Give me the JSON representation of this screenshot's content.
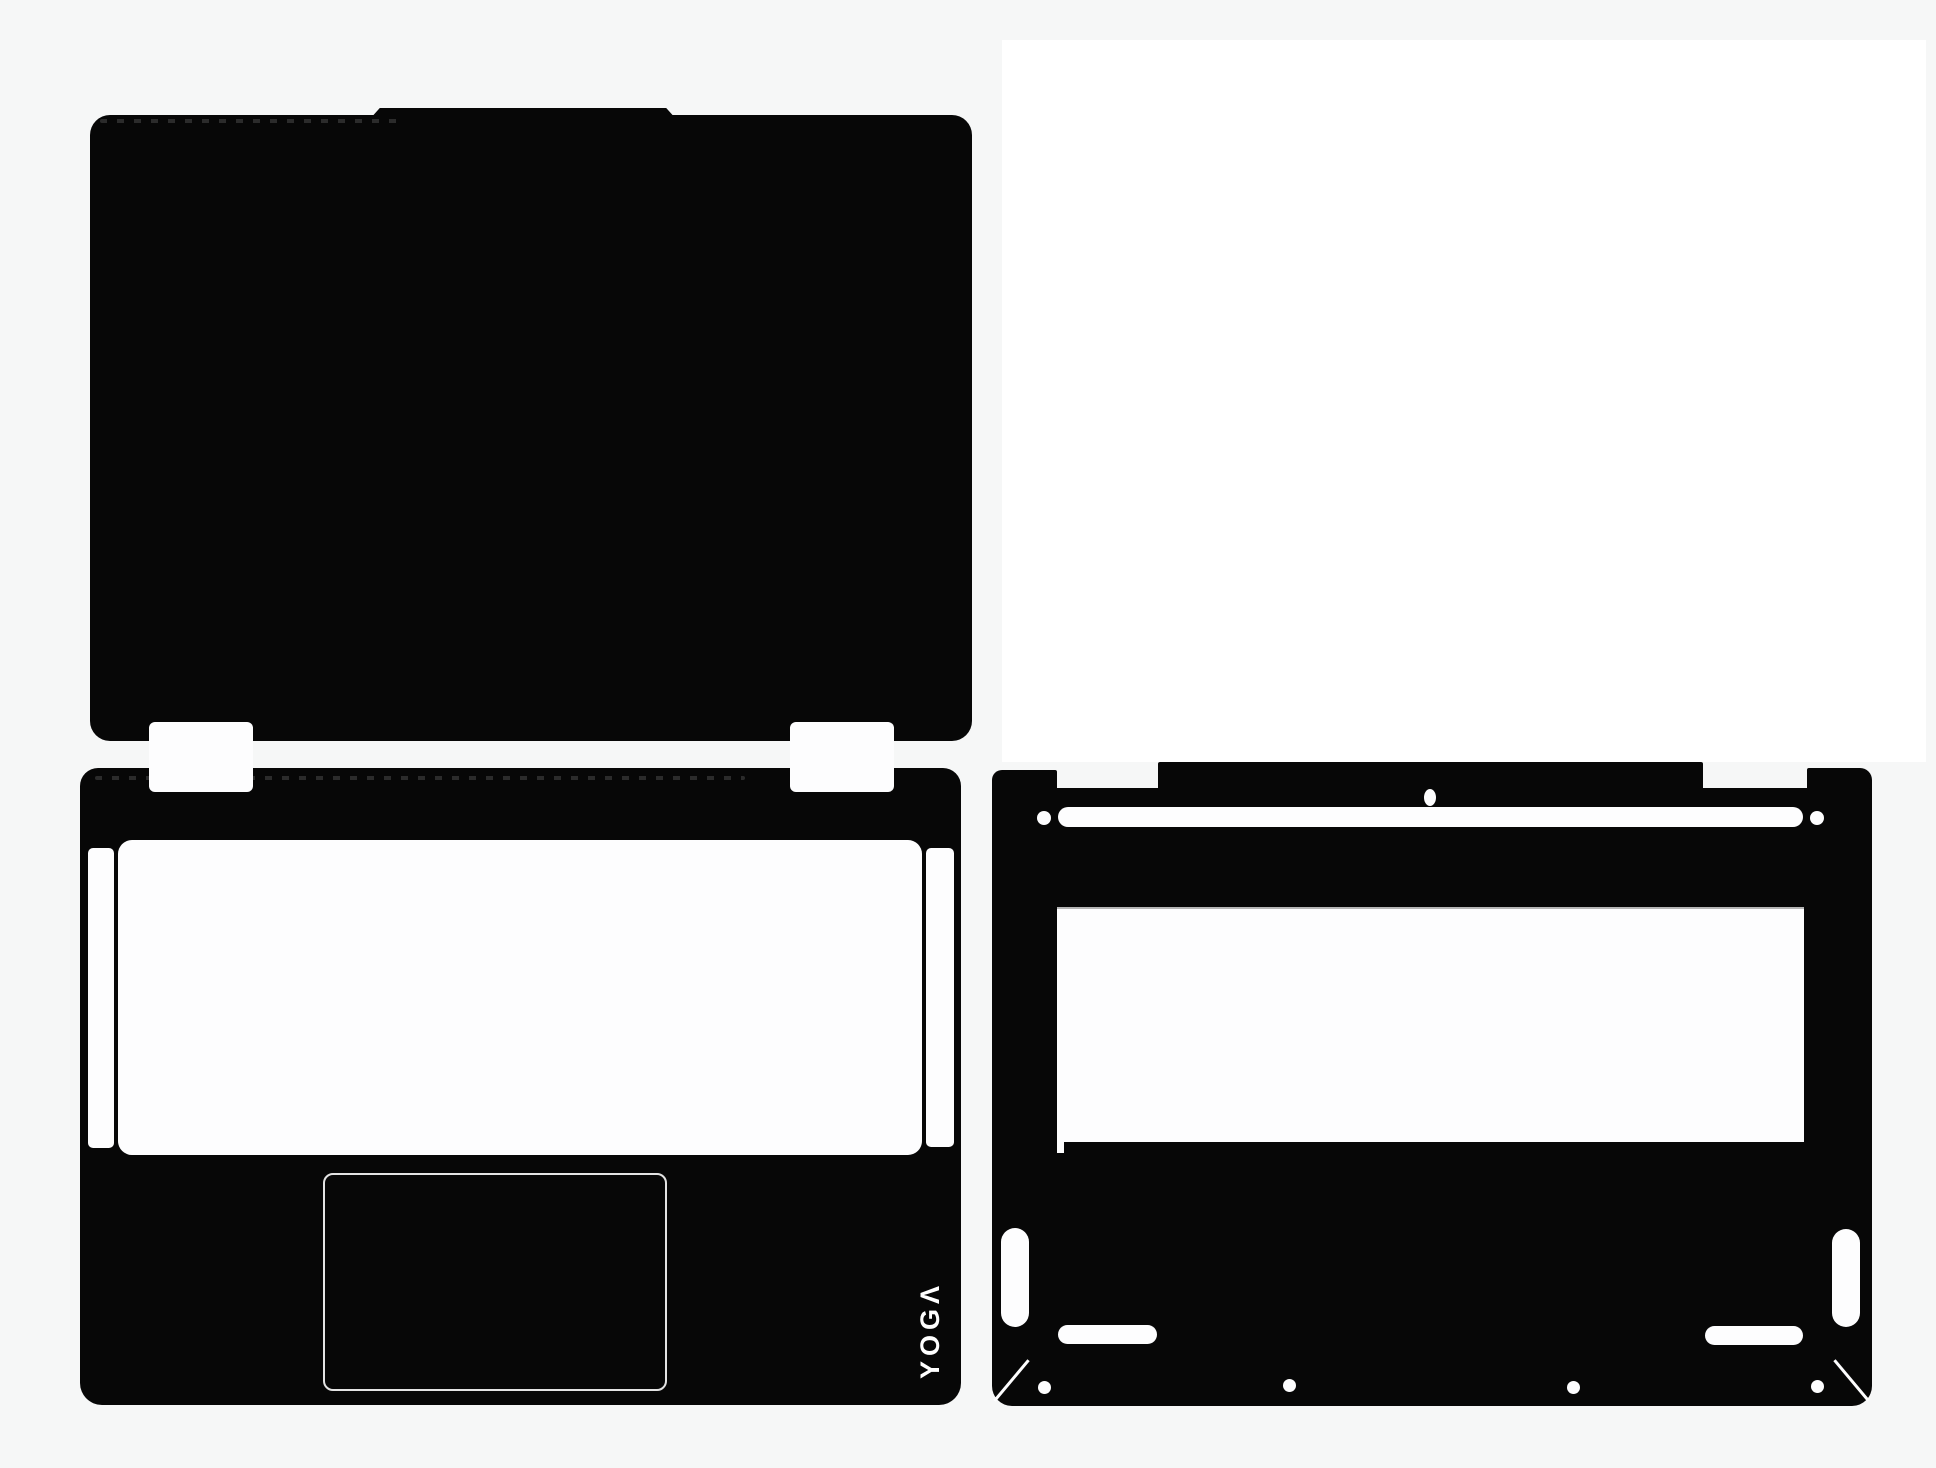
{
  "image": {
    "kind": "product-photo",
    "subject": "laptop vinyl skin die-cut set for Lenovo YOGA (lid cover, palmrest, bottom cover)",
    "background_color": "#f6f7f7",
    "photo_backdrop_color": "#ffffff"
  },
  "colors": {
    "skin_black": "#070707",
    "cutout_white": "#fdfdfe",
    "trackpad_outline_gray": "#e3e3e3",
    "vent_edge_gray": "#b5b5b5",
    "perforation_gray": "#2b2b2b"
  },
  "logo": {
    "text": "YOGA",
    "display": "YOGΛ",
    "color": "#ffffff",
    "orientation": "rotated -90deg, reads bottom to top"
  },
  "pieces": {
    "lid_skin": "black rounded rectangle with raised top notch and perforation dashes",
    "palmrest_skin": "black rounded rectangle with keyboard cutout, two side strips, trackpad outline, YOGA logo",
    "bottom_cover_skin": "black rounded rectangle with hinge bar, vent slot, label window, rubber-feet cutouts, four screw holes, two diagonal corner cuts",
    "hinge_tabs": "two white tab cutouts between lid and palmrest pieces"
  }
}
